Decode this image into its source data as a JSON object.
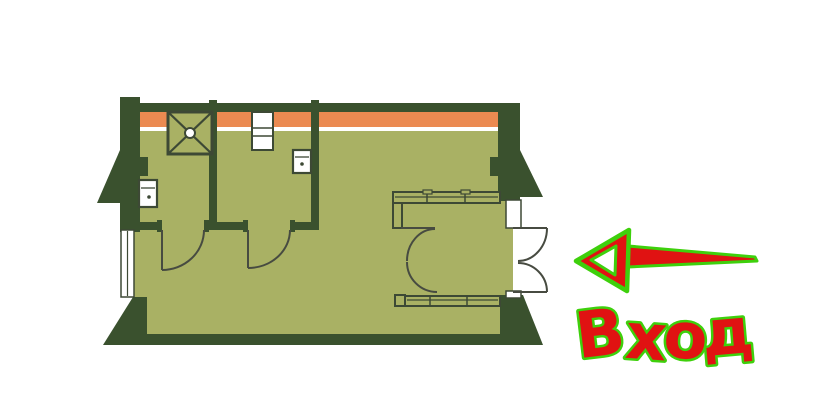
{
  "entrance": {
    "label": "Вход"
  },
  "icons": {
    "entrance_arrow": "left-arrow",
    "shower": "shower-cabin",
    "sink": "washbasin",
    "window": "window",
    "doors": "swing-door-arc",
    "wardrobe": "segmented-counter"
  },
  "palette": {
    "background": "#ffffff",
    "floor": "#a9b164",
    "wall": "#3a512e",
    "outline": "#3d4935",
    "doorline": "#474b41",
    "accent_orange": "#eb8a51",
    "white": "#ffffff",
    "arrow_red": "#e01212",
    "arrow_green": "#3ed00c",
    "label_red": "#e01212",
    "label_green": "#3ed00c"
  }
}
